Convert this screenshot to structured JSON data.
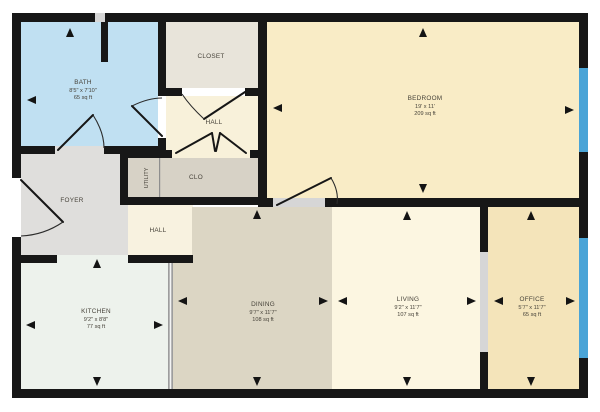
{
  "title": "Floor plan",
  "rooms": {
    "bath": {
      "name": "BATH",
      "dims": "8'5\" x 7'10\"",
      "area": "65 sq ft"
    },
    "closet": {
      "name": "CLOSET"
    },
    "hall_upper": {
      "name": "HALL"
    },
    "utility": {
      "name": "UTILITY"
    },
    "clo": {
      "name": "CLO"
    },
    "foyer": {
      "name": "FOYER"
    },
    "hall_lower": {
      "name": "HALL"
    },
    "bedroom": {
      "name": "BEDROOM",
      "dims": "19' x 11'",
      "area": "209 sq ft"
    },
    "kitchen": {
      "name": "KITCHEN",
      "dims": "9'2\" x 8'8\"",
      "area": "77 sq ft"
    },
    "dining": {
      "name": "DINING",
      "dims": "9'7\" x 11'7\"",
      "area": "108 sq ft"
    },
    "living": {
      "name": "LIVING",
      "dims": "9'2\" x 11'7\"",
      "area": "107 sq ft"
    },
    "office": {
      "name": "OFFICE",
      "dims": "5'7\" x 11'7\"",
      "area": "65 sq ft"
    }
  },
  "theme": {
    "wall": "#171717",
    "window": "#4aa4d7",
    "opening": "#d6d6d6",
    "bath": "#c0e0f2",
    "closet": "#e8e4da",
    "hall_upper": "#f8f1da",
    "utility": "#d7d2c6",
    "foyer": "#dfdedc",
    "hall_lower": "#f8f2e0",
    "kitchen": "#edf2ec",
    "dining": "#dcd6c4",
    "living": "#fcf6e1",
    "bedroom": "#f9ecc6",
    "office": "#f4e4ba"
  }
}
